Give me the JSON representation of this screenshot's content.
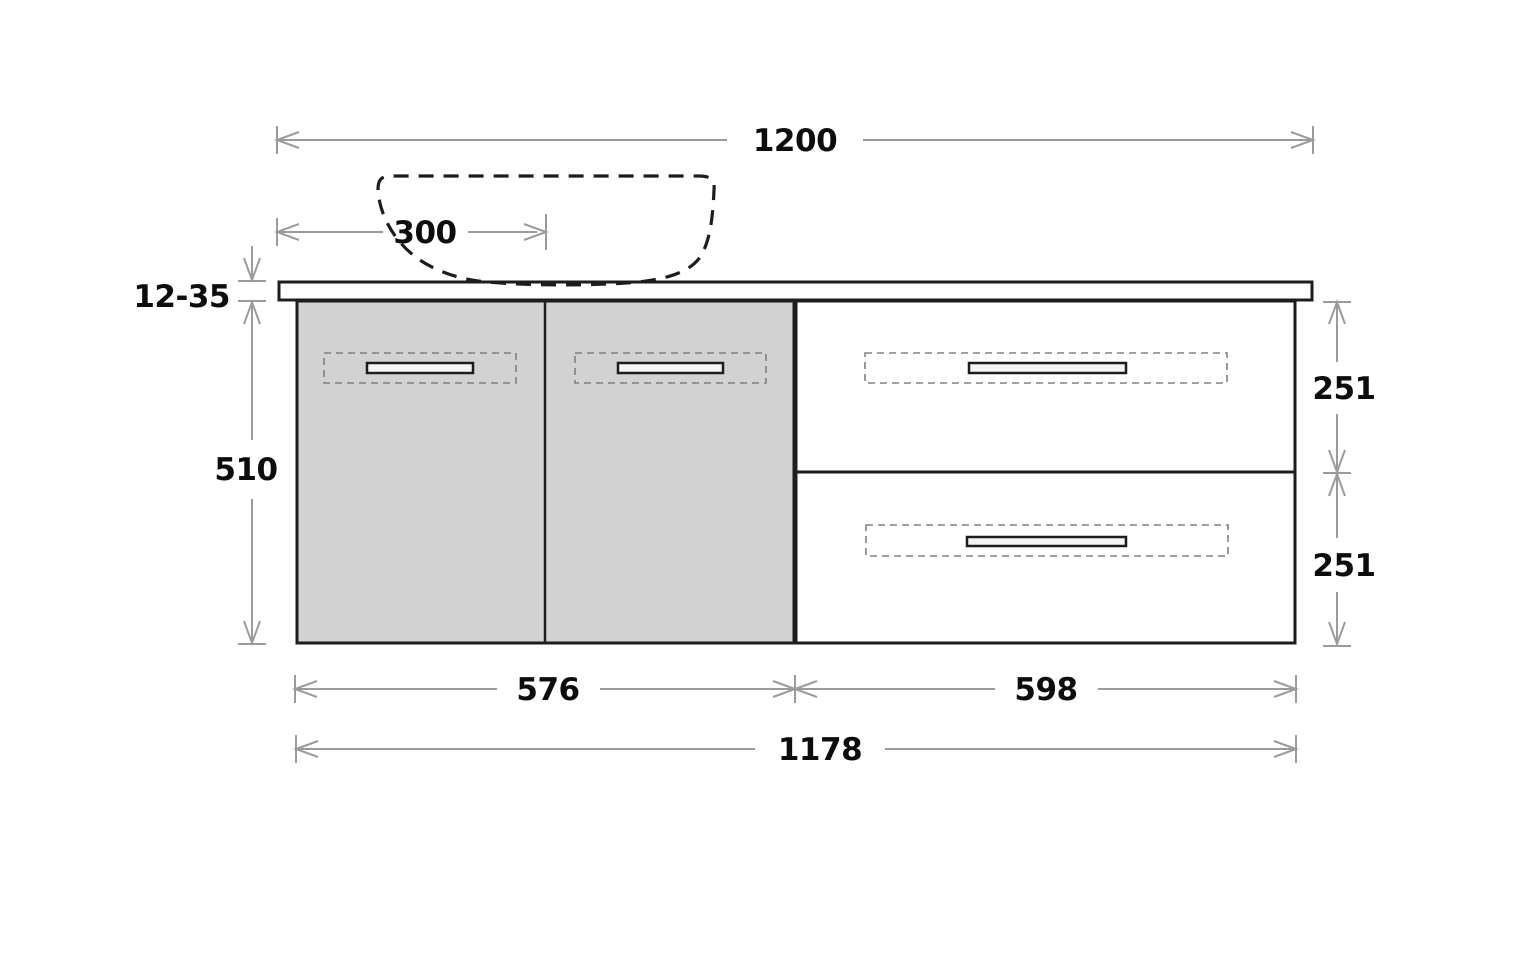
{
  "diagram": {
    "kind": "technical-drawing",
    "dimensions": {
      "total_width": "1200",
      "basin_center_offset": "300",
      "countertop_thickness": "12-35",
      "cabinet_height": "510",
      "top_drawer_height": "251",
      "bottom_drawer_height": "251",
      "doors_section_width": "576",
      "drawers_section_width": "598",
      "cabinet_width": "1178"
    },
    "colors": {
      "line_black": "#1d1d1d",
      "dimension_gray": "#9b9b9b",
      "door_fill": "#d2d2d2",
      "background": "#ffffff",
      "label_ink": "#0d0d0d",
      "handle_zone_dash": "#808080"
    }
  }
}
